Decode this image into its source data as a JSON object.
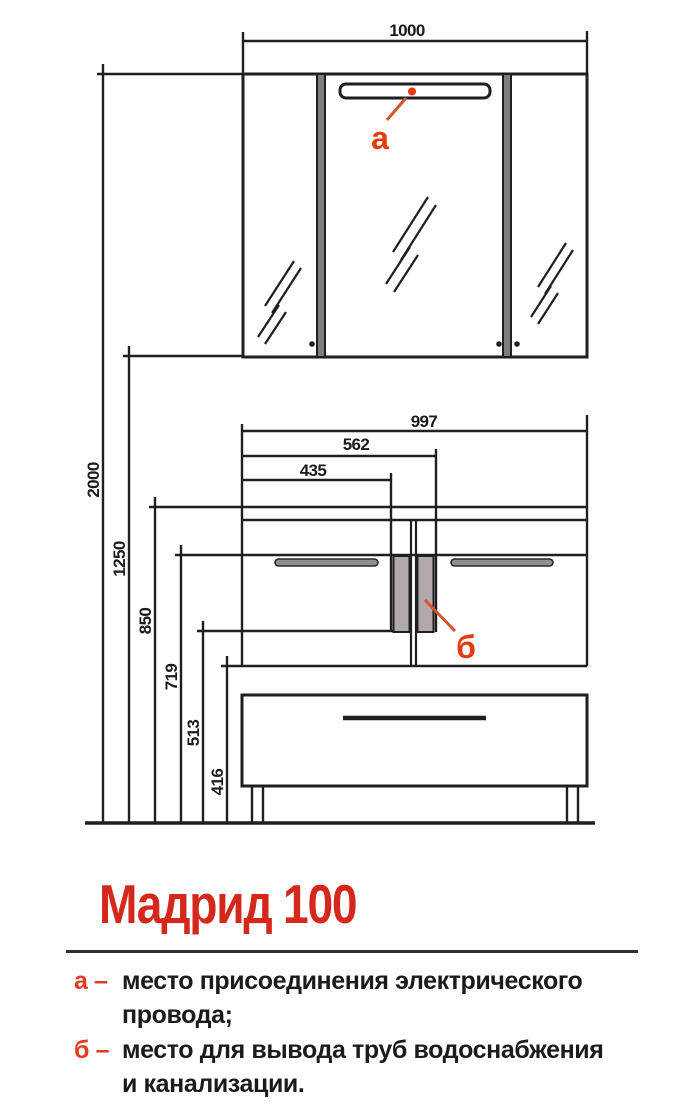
{
  "title": "Мадрид 100",
  "drawing": {
    "dims": {
      "w1000": "1000",
      "w997": "997",
      "w562": "562",
      "w435": "435",
      "h2000": "2000",
      "h1250": "1250",
      "h850": "850",
      "h719": "719",
      "h513": "513",
      "h416": "416"
    },
    "callouts": {
      "a": "а",
      "b": "б"
    }
  },
  "legend": [
    {
      "key": "а –",
      "line1": "место присоединения электрического",
      "line2": "провода;"
    },
    {
      "key": "б –",
      "line1": "место для вывода труб водоснабжения",
      "line2": "и канализации."
    }
  ],
  "colors": {
    "line": "#1f1f1f",
    "title_red": "#d5281c",
    "callout_orange": "#e8380d",
    "leader_orange": "#d85420",
    "panel_grey": "#b3a9ac",
    "divider_grey": "#7e7e7e",
    "handle_grey": "#8f8f8f"
  }
}
